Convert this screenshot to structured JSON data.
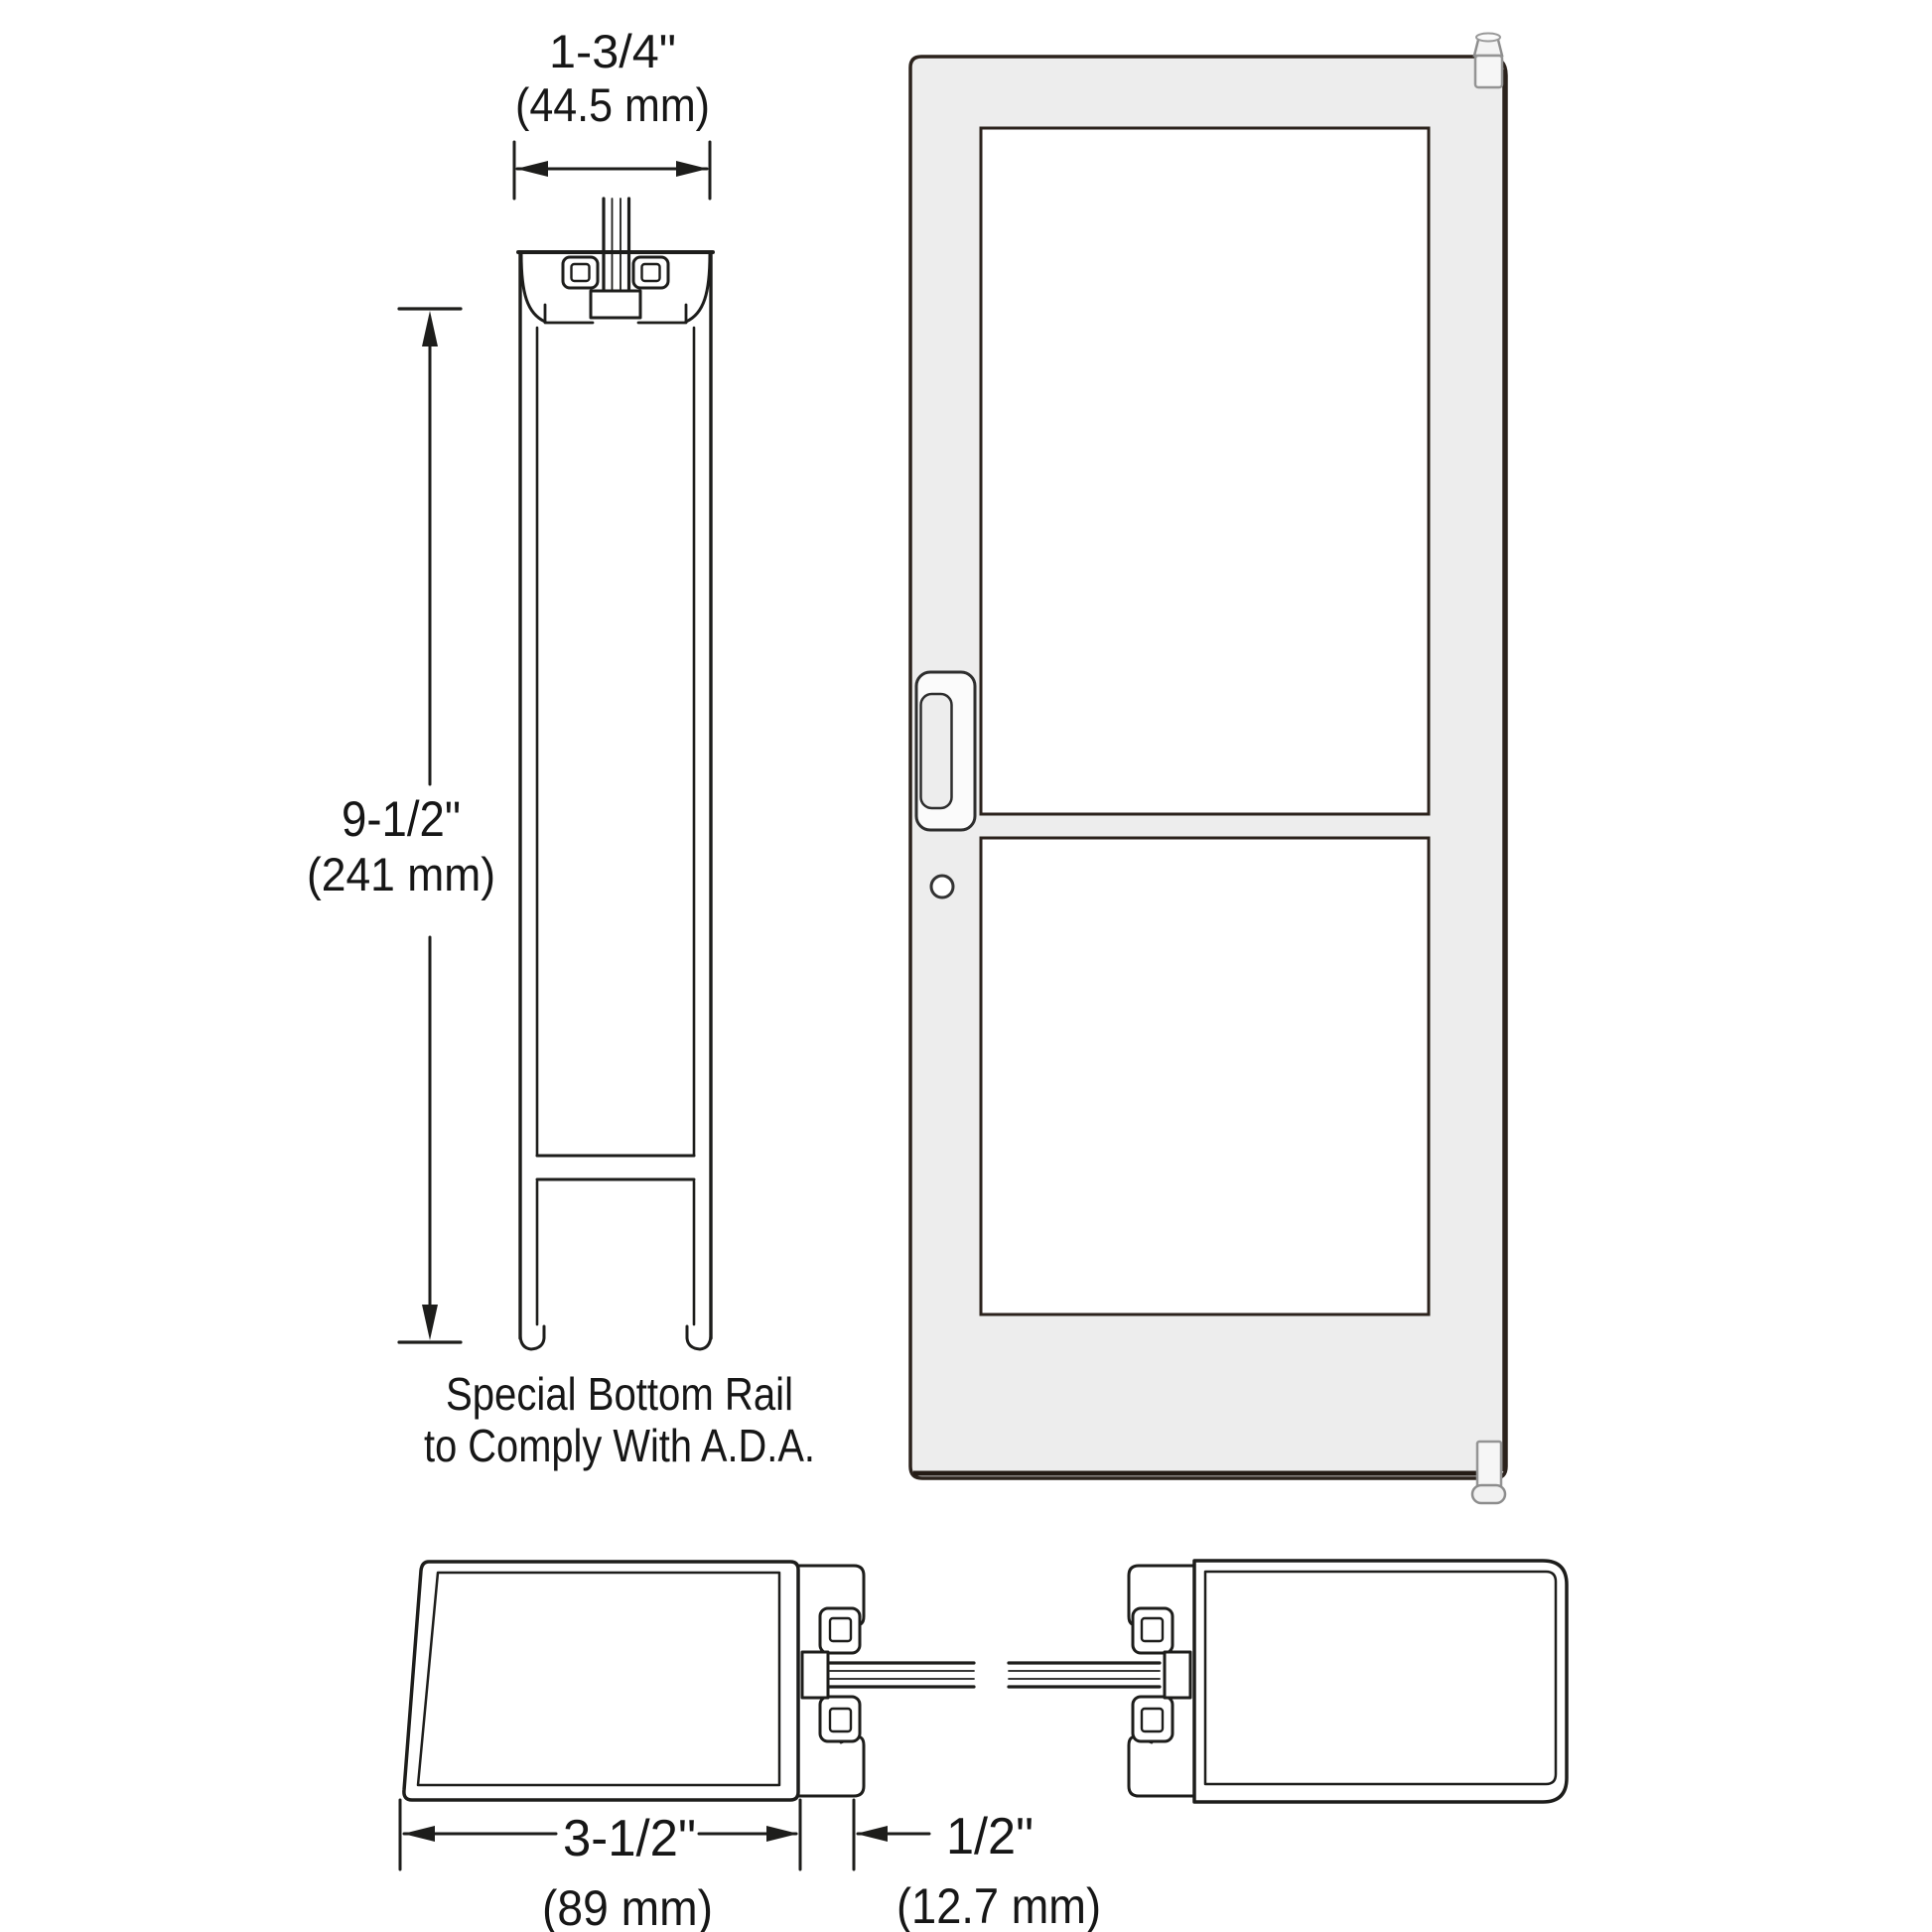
{
  "drawing": {
    "colors": {
      "background": "#ffffff",
      "line": "#1d1d1b",
      "door_outline": "#2b221c",
      "door_frame_fill": "#ededed",
      "glass_fill": "#ffffff",
      "hardware_outline": "#8d8d8d"
    },
    "dimensions": {
      "door_thickness": {
        "imperial": "1-3/4\"",
        "metric": "(44.5 mm)"
      },
      "bottom_rail_height": {
        "imperial": "9-1/2\"",
        "metric": "(241 mm)"
      },
      "stile_width": {
        "imperial": "3-1/2\"",
        "metric": "(89 mm)"
      },
      "glass_stop_gap": {
        "imperial": "1/2\"",
        "metric": "(12.7 mm)"
      }
    },
    "note": {
      "line1": "Special Bottom Rail",
      "line2": "to Comply With A.D.A."
    }
  }
}
